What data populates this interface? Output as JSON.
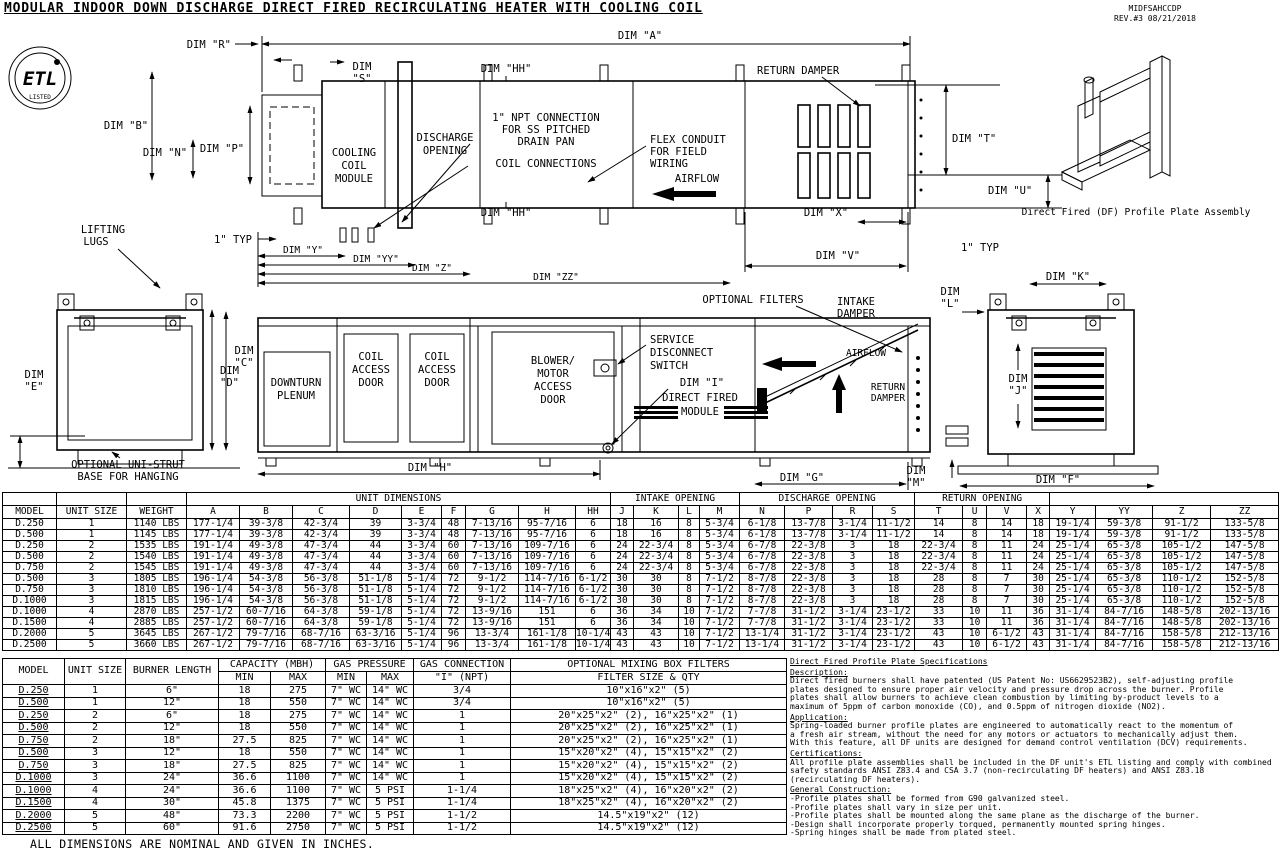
{
  "doc": {
    "title": "MODULAR INDOOR DOWN DISCHARGE DIRECT FIRED RECIRCULATING HEATER WITH COOLING COIL",
    "doc_id": "MIDFSAHCCDP",
    "revision": "REV.#3   08/21/2018",
    "footnote": "ALL DIMENSIONS ARE NOMINAL AND GIVEN IN INCHES."
  },
  "drawing": {
    "etl": {
      "mark": "ETL",
      "listed": "LISTED"
    },
    "airflow": "AIRFLOW",
    "return_damper": "RETURN DAMPER",
    "one_typ": "1\" TYP",
    "top": {
      "dim_a": "DIM \"A\"",
      "dim_r": "DIM \"R\"",
      "dim_s": [
        "DIM",
        "\"S\""
      ],
      "dim_hh": "DIM \"HH\"",
      "dim_b": "DIM \"B\"",
      "dim_n": "DIM \"N\"",
      "dim_p": "DIM \"P\"",
      "cooling_coil": [
        "COOLING",
        "COIL",
        "MODULE"
      ],
      "discharge_opening": [
        "DISCHARGE",
        "OPENING"
      ],
      "npt": [
        "1\" NPT CONNECTION",
        "FOR SS PITCHED",
        "DRAIN PAN"
      ],
      "coil_connections": "COIL CONNECTIONS",
      "flex_conduit": [
        "FLEX CONDUIT",
        "FOR FIELD",
        "WIRING"
      ],
      "lifting_lugs": [
        "LIFTING",
        "LUGS"
      ],
      "dim_t": "DIM \"T\"",
      "dim_u": "DIM \"U\"",
      "dim_x": "DIM \"X\"",
      "dim_v": "DIM \"V\"",
      "dim_y": "DIM \"Y\"",
      "dim_yy": "DIM \"YY\"",
      "dim_z": "DIM \"Z\"",
      "dim_zz": "DIM \"ZZ\""
    },
    "side": {
      "dim_d": [
        "DIM",
        "\"D\""
      ],
      "dim_e": [
        "DIM",
        "\"E\""
      ],
      "dim_c": [
        "DIM",
        "\"C\""
      ],
      "uni_strut": [
        "OPTIONAL UNI-STRUT",
        "BASE FOR HANGING"
      ],
      "downturn_plenum": [
        "DOWNTURN",
        "PLENUM"
      ],
      "coil_access_door": [
        "COIL",
        "ACCESS",
        "DOOR"
      ],
      "blower_door": [
        "BLOWER/",
        "MOTOR",
        "ACCESS",
        "DOOR"
      ],
      "service_switch": [
        "SERVICE",
        "DISCONNECT",
        "SWITCH"
      ],
      "dim_i": "DIM \"I\"",
      "df_module": [
        "DIRECT FIRED",
        "MODULE"
      ],
      "optional_filters": "OPTIONAL FILTERS",
      "intake_damper": [
        "INTAKE",
        "DAMPER"
      ],
      "return_damper_2": [
        "RETURN",
        "DAMPER"
      ],
      "dim_h": "DIM \"H\"",
      "dim_g": "DIM \"G\"",
      "dim_l": [
        "DIM",
        "\"L\""
      ],
      "dim_k": "DIM \"K\"",
      "dim_j": [
        "DIM",
        "\"J\""
      ],
      "dim_m": [
        "DIM",
        "\"M\""
      ],
      "dim_f": "DIM \"F\""
    },
    "iso_caption": "Direct Fired (DF) Profile Plate Assembly"
  },
  "table1": {
    "group_headers": [
      "UNIT DIMENSIONS",
      "INTAKE OPENING",
      "DISCHARGE OPENING",
      "RETURN OPENING"
    ],
    "columns": [
      "MODEL",
      "UNIT SIZE",
      "WEIGHT",
      "A",
      "B",
      "C",
      "D",
      "E",
      "F",
      "G",
      "H",
      "HH",
      "J",
      "K",
      "L",
      "M",
      "N",
      "P",
      "R",
      "S",
      "T",
      "U",
      "V",
      "X",
      "Y",
      "YY",
      "Z",
      "ZZ"
    ],
    "rows": [
      [
        "D.250",
        "1",
        "1140 LBS",
        "177-1/4",
        "39-3/8",
        "42-3/4",
        "39",
        "3-3/4",
        "48",
        "7-13/16",
        "95-7/16",
        "6",
        "18",
        "16",
        "8",
        "5-3/4",
        "6-1/8",
        "13-7/8",
        "3-1/4",
        "11-1/2",
        "14",
        "8",
        "14",
        "18",
        "19-1/4",
        "59-3/8",
        "91-1/2",
        "133-5/8"
      ],
      [
        "D.500",
        "1",
        "1145 LBS",
        "177-1/4",
        "39-3/8",
        "42-3/4",
        "39",
        "3-3/4",
        "48",
        "7-13/16",
        "95-7/16",
        "6",
        "18",
        "16",
        "8",
        "5-3/4",
        "6-1/8",
        "13-7/8",
        "3-1/4",
        "11-1/2",
        "14",
        "8",
        "14",
        "18",
        "19-1/4",
        "59-3/8",
        "91-1/2",
        "133-5/8"
      ],
      [
        "D.250",
        "2",
        "1535 LBS",
        "191-1/4",
        "49-3/8",
        "47-3/4",
        "44",
        "3-3/4",
        "60",
        "7-13/16",
        "109-7/16",
        "6",
        "24",
        "22-3/4",
        "8",
        "5-3/4",
        "6-7/8",
        "22-3/8",
        "3",
        "18",
        "22-3/4",
        "8",
        "11",
        "24",
        "25-1/4",
        "65-3/8",
        "105-1/2",
        "147-5/8"
      ],
      [
        "D.500",
        "2",
        "1540 LBS",
        "191-1/4",
        "49-3/8",
        "47-3/4",
        "44",
        "3-3/4",
        "60",
        "7-13/16",
        "109-7/16",
        "6",
        "24",
        "22-3/4",
        "8",
        "5-3/4",
        "6-7/8",
        "22-3/8",
        "3",
        "18",
        "22-3/4",
        "8",
        "11",
        "24",
        "25-1/4",
        "65-3/8",
        "105-1/2",
        "147-5/8"
      ],
      [
        "D.750",
        "2",
        "1545 LBS",
        "191-1/4",
        "49-3/8",
        "47-3/4",
        "44",
        "3-3/4",
        "60",
        "7-13/16",
        "109-7/16",
        "6",
        "24",
        "22-3/4",
        "8",
        "5-3/4",
        "6-7/8",
        "22-3/8",
        "3",
        "18",
        "22-3/4",
        "8",
        "11",
        "24",
        "25-1/4",
        "65-3/8",
        "105-1/2",
        "147-5/8"
      ],
      [
        "D.500",
        "3",
        "1805 LBS",
        "196-1/4",
        "54-3/8",
        "56-3/8",
        "51-1/8",
        "5-1/4",
        "72",
        "9-1/2",
        "114-7/16",
        "6-1/2",
        "30",
        "30",
        "8",
        "7-1/2",
        "8-7/8",
        "22-3/8",
        "3",
        "18",
        "28",
        "8",
        "7",
        "30",
        "25-1/4",
        "65-3/8",
        "110-1/2",
        "152-5/8"
      ],
      [
        "D.750",
        "3",
        "1810 LBS",
        "196-1/4",
        "54-3/8",
        "56-3/8",
        "51-1/8",
        "5-1/4",
        "72",
        "9-1/2",
        "114-7/16",
        "6-1/2",
        "30",
        "30",
        "8",
        "7-1/2",
        "8-7/8",
        "22-3/8",
        "3",
        "18",
        "28",
        "8",
        "7",
        "30",
        "25-1/4",
        "65-3/8",
        "110-1/2",
        "152-5/8"
      ],
      [
        "D.1000",
        "3",
        "1815 LBS",
        "196-1/4",
        "54-3/8",
        "56-3/8",
        "51-1/8",
        "5-1/4",
        "72",
        "9-1/2",
        "114-7/16",
        "6-1/2",
        "30",
        "30",
        "8",
        "7-1/2",
        "8-7/8",
        "22-3/8",
        "3",
        "18",
        "28",
        "8",
        "7",
        "30",
        "25-1/4",
        "65-3/8",
        "110-1/2",
        "152-5/8"
      ],
      [
        "D.1000",
        "4",
        "2870 LBS",
        "257-1/2",
        "60-7/16",
        "64-3/8",
        "59-1/8",
        "5-1/4",
        "72",
        "13-9/16",
        "151",
        "6",
        "36",
        "34",
        "10",
        "7-1/2",
        "7-7/8",
        "31-1/2",
        "3-1/4",
        "23-1/2",
        "33",
        "10",
        "11",
        "36",
        "31-1/4",
        "84-7/16",
        "148-5/8",
        "202-13/16"
      ],
      [
        "D.1500",
        "4",
        "2885 LBS",
        "257-1/2",
        "60-7/16",
        "64-3/8",
        "59-1/8",
        "5-1/4",
        "72",
        "13-9/16",
        "151",
        "6",
        "36",
        "34",
        "10",
        "7-1/2",
        "7-7/8",
        "31-1/2",
        "3-1/4",
        "23-1/2",
        "33",
        "10",
        "11",
        "36",
        "31-1/4",
        "84-7/16",
        "148-5/8",
        "202-13/16"
      ],
      [
        "D.2000",
        "5",
        "3645 LBS",
        "267-1/2",
        "79-7/16",
        "68-7/16",
        "63-3/16",
        "5-1/4",
        "96",
        "13-3/4",
        "161-1/8",
        "10-1/4",
        "43",
        "43",
        "10",
        "7-1/2",
        "13-1/4",
        "31-1/2",
        "3-1/4",
        "23-1/2",
        "43",
        "10",
        "6-1/2",
        "43",
        "31-1/4",
        "84-7/16",
        "158-5/8",
        "212-13/16"
      ],
      [
        "D.2500",
        "5",
        "3660 LBS",
        "267-1/2",
        "79-7/16",
        "68-7/16",
        "63-3/16",
        "5-1/4",
        "96",
        "13-3/4",
        "161-1/8",
        "10-1/4",
        "43",
        "43",
        "10",
        "7-1/2",
        "13-1/4",
        "31-1/2",
        "3-1/4",
        "23-1/2",
        "43",
        "10",
        "6-1/2",
        "43",
        "31-1/4",
        "84-7/16",
        "158-5/8",
        "212-13/16"
      ]
    ]
  },
  "table2": {
    "headers": {
      "model": "MODEL",
      "unit_size": "UNIT SIZE",
      "burner_length": "BURNER LENGTH",
      "capacity": "CAPACITY (MBH)",
      "gas_pressure": "GAS PRESSURE",
      "gas_connection": "GAS CONNECTION",
      "gas_connection_sub": "\"I\" (NPT)",
      "filters": "OPTIONAL MIXING BOX FILTERS",
      "filters_sub": "FILTER SIZE & QTY",
      "min": "MIN",
      "max": "MAX"
    },
    "rows": [
      [
        "D.250",
        "1",
        "6\"",
        "18",
        "275",
        "7\" WC",
        "14\" WC",
        "3/4",
        "10\"x16\"x2\" (5)"
      ],
      [
        "D.500",
        "1",
        "12\"",
        "18",
        "550",
        "7\" WC",
        "14\" WC",
        "3/4",
        "10\"x16\"x2\" (5)"
      ],
      [
        "D.250",
        "2",
        "6\"",
        "18",
        "275",
        "7\" WC",
        "14\" WC",
        "1",
        "20\"x25\"x2\" (2), 16\"x25\"x2\" (1)"
      ],
      [
        "D.500",
        "2",
        "12\"",
        "18",
        "550",
        "7\" WC",
        "14\" WC",
        "1",
        "20\"x25\"x2\" (2), 16\"x25\"x2\" (1)"
      ],
      [
        "D.750",
        "2",
        "18\"",
        "27.5",
        "825",
        "7\" WC",
        "14\" WC",
        "1",
        "20\"x25\"x2\" (2), 16\"x25\"x2\" (1)"
      ],
      [
        "D.500",
        "3",
        "12\"",
        "18",
        "550",
        "7\" WC",
        "14\" WC",
        "1",
        "15\"x20\"x2\" (4), 15\"x15\"x2\" (2)"
      ],
      [
        "D.750",
        "3",
        "18\"",
        "27.5",
        "825",
        "7\" WC",
        "14\" WC",
        "1",
        "15\"x20\"x2\" (4), 15\"x15\"x2\" (2)"
      ],
      [
        "D.1000",
        "3",
        "24\"",
        "36.6",
        "1100",
        "7\" WC",
        "14\" WC",
        "1",
        "15\"x20\"x2\" (4), 15\"x15\"x2\" (2)"
      ],
      [
        "D.1000",
        "4",
        "24\"",
        "36.6",
        "1100",
        "7\" WC",
        "5 PSI",
        "1-1/4",
        "18\"x25\"x2\" (4), 16\"x20\"x2\" (2)"
      ],
      [
        "D.1500",
        "4",
        "30\"",
        "45.8",
        "1375",
        "7\" WC",
        "5 PSI",
        "1-1/4",
        "18\"x25\"x2\" (4), 16\"x20\"x2\" (2)"
      ],
      [
        "D.2000",
        "5",
        "48\"",
        "73.3",
        "2200",
        "7\" WC",
        "5 PSI",
        "1-1/2",
        "14.5\"x19\"x2\" (12)"
      ],
      [
        "D.2500",
        "5",
        "60\"",
        "91.6",
        "2750",
        "7\" WC",
        "5 PSI",
        "1-1/2",
        "14.5\"x19\"x2\" (12)"
      ]
    ]
  },
  "specs": {
    "title": "Direct Fired Profile Plate Specifications",
    "sections": [
      {
        "heading": "Description:",
        "lines": [
          "Direct fired burners shall have patented (US Patent No: US6629523B2), self-adjusting profile",
          "plates designed to ensure proper air velocity and pressure drop across the burner. Profile",
          "plates shall allow burners to achieve clean combustion by limiting by-product levels to a",
          "maximum of 5ppm of carbon monoxide (CO), and 0.5ppm of nitrogen dioxide (NO2)."
        ]
      },
      {
        "heading": "Application:",
        "lines": [
          "Spring-loaded burner profile plates are engineered to automatically react to the momentum of",
          "a fresh air stream, without the need for any motors or actuators to mechanically adjust them.",
          "With this feature, all DF units are designed for demand control ventilation (DCV) requirements."
        ]
      },
      {
        "heading": "Certifications:",
        "lines": [
          "All profile plate assemblies shall be included in the DF unit's ETL listing and comply with combined",
          "safety standards ANSI Z83.4 and CSA 3.7 (non-recirculating DF heaters) and ANSI Z83.18",
          "(recirculating DF heaters)."
        ]
      },
      {
        "heading": "General Construction:",
        "lines": [
          "-Profile plates shall be formed from G90 galvanized steel.",
          "-Profile plates shall vary in size per unit.",
          "-Profile plates shall be mounted along the same plane as the discharge of the burner.",
          "-Design shall incorporate properly torqued, permanently mounted spring hinges.",
          "-Spring hinges shall be made from plated steel."
        ]
      }
    ]
  }
}
